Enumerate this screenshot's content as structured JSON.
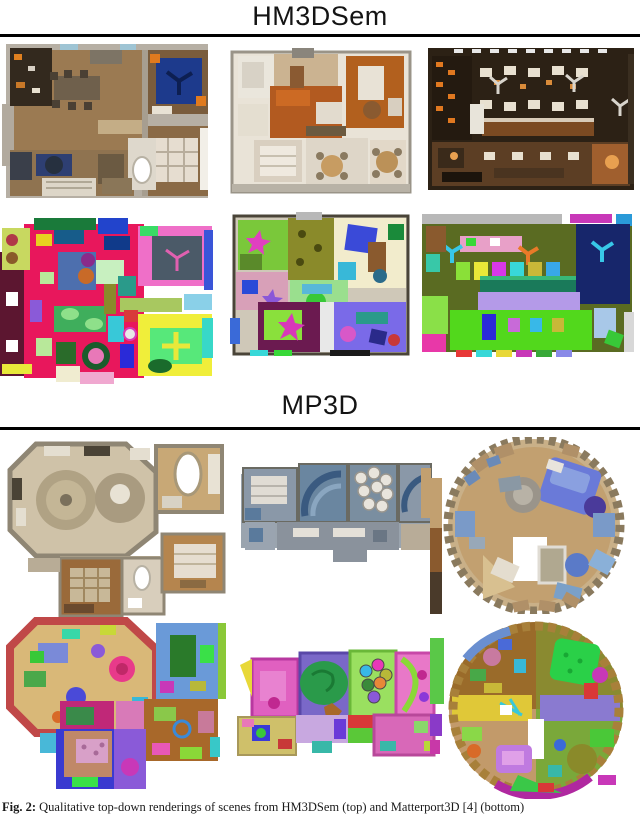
{
  "figure": {
    "sections": [
      {
        "id": "hm3dsem",
        "title": "HM3DSem"
      },
      {
        "id": "mp3d",
        "title": "MP3D"
      }
    ],
    "caption": {
      "tag": "Fig. 2:",
      "text": " Qualitative top-down renderings of scenes from HM3DSem (top) and Matterport3D [4] (bottom)"
    },
    "rule_color": "#000000",
    "background_color": "#ffffff"
  }
}
